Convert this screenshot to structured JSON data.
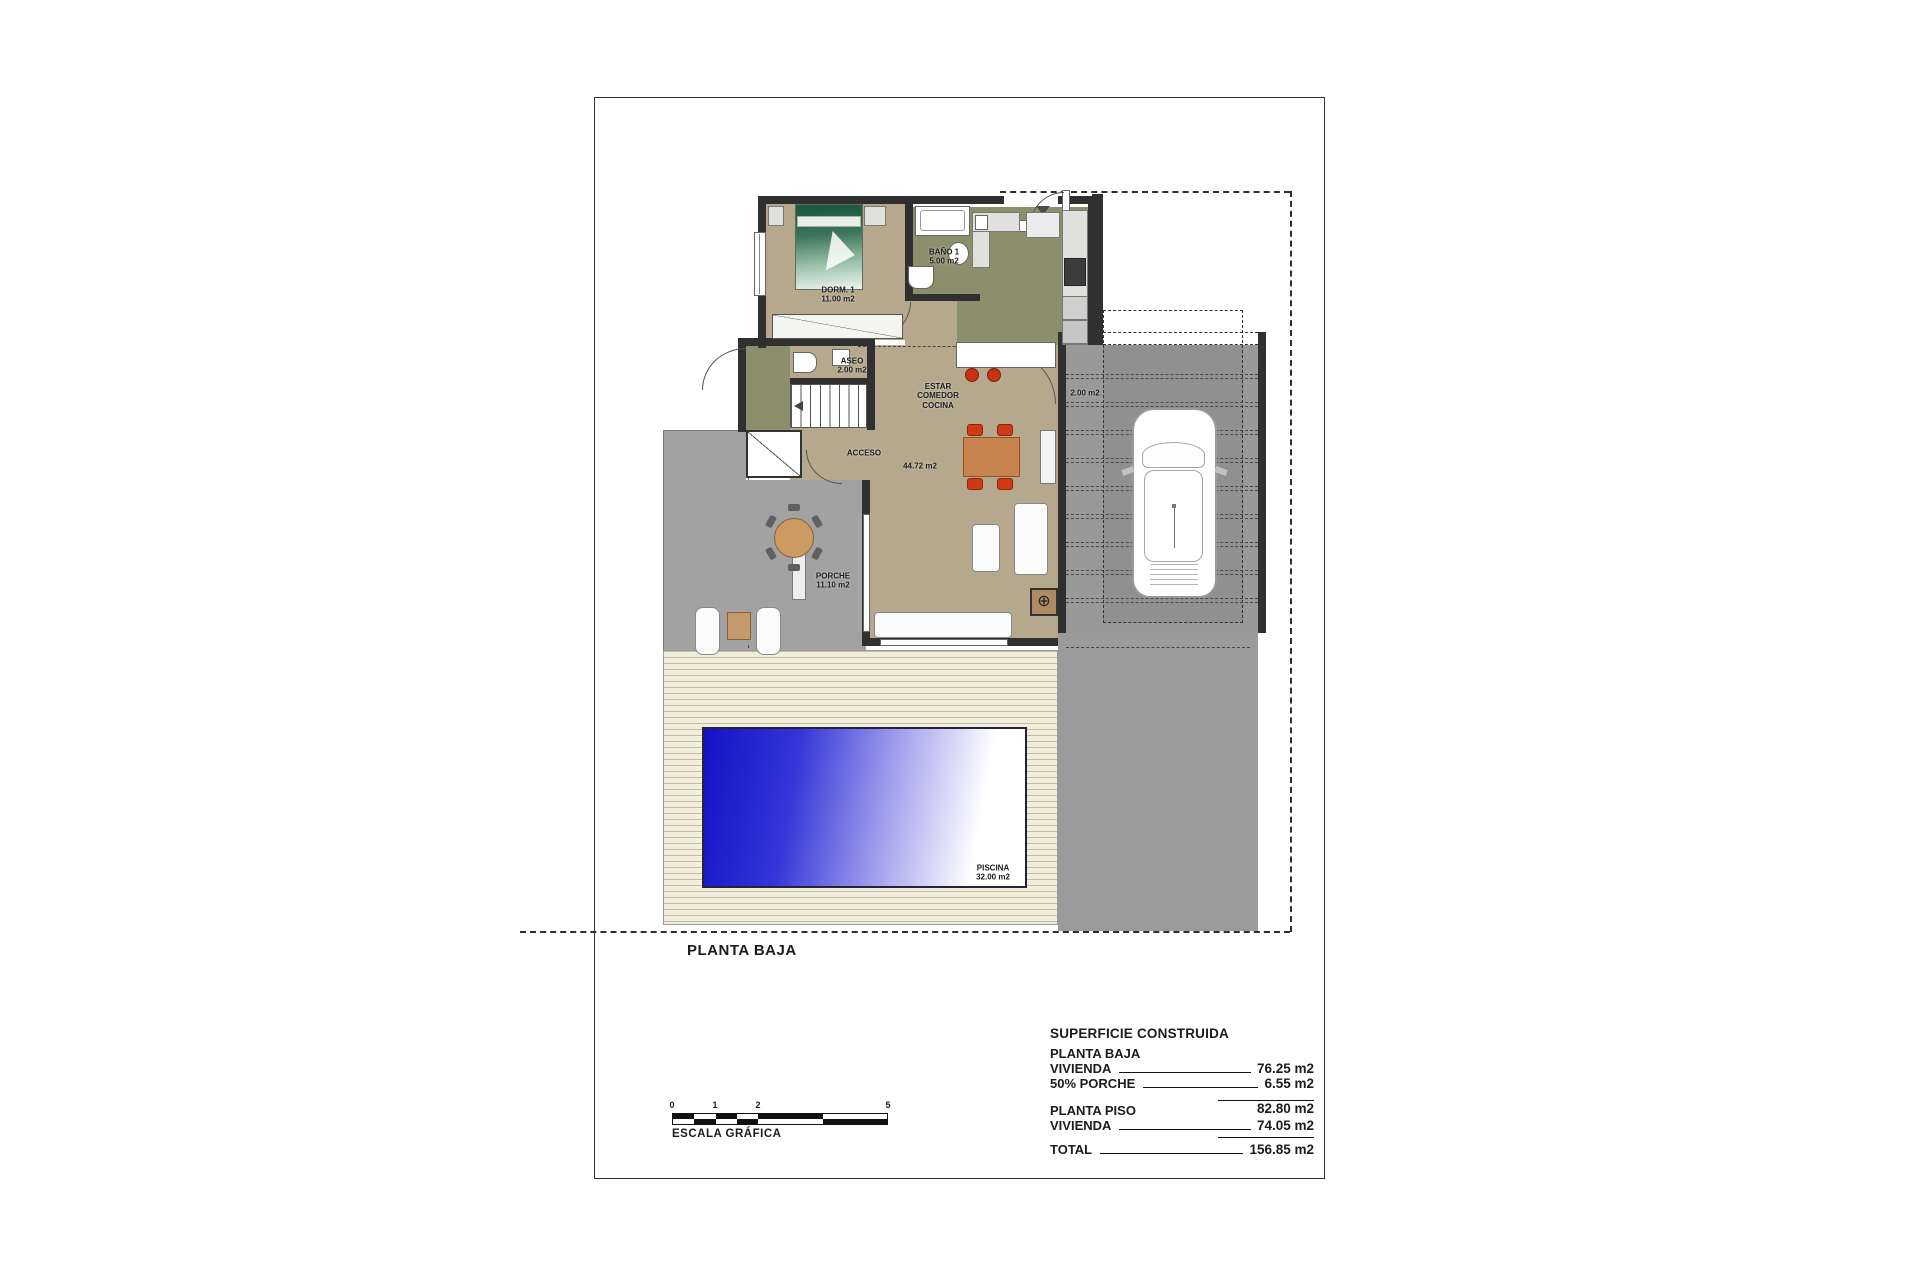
{
  "page": {
    "title": "PLANTA BAJA"
  },
  "rooms": {
    "dorm": {
      "name": "DORM. 1",
      "area": "11.00 m2"
    },
    "bano": {
      "name": "BAÑO 1",
      "area": "5.00 m2"
    },
    "aseo": {
      "name": "ASEO",
      "area": "2.00 m2"
    },
    "estar": {
      "line1": "ESTAR",
      "line2": "COMEDOR",
      "line3": "COCINA",
      "area": "44.72 m2"
    },
    "acceso": {
      "name": "ACCESO"
    },
    "porche": {
      "name": "PORCHE",
      "area": "11.10 m2"
    },
    "lateral": {
      "area": "2.00 m2"
    },
    "piscina": {
      "name": "PISCINA",
      "area": "32.00 m2"
    }
  },
  "scale": {
    "label": "ESCALA GRÁFICA",
    "ticks": [
      "0",
      "1",
      "2",
      "5"
    ]
  },
  "table": {
    "header": "SUPERFICIE CONSTRUIDA",
    "sections": [
      {
        "title": "PLANTA BAJA",
        "rows": [
          {
            "label": "VIVIENDA",
            "value": "76.25 m2"
          },
          {
            "label": "50% PORCHE",
            "value": "6.55 m2"
          }
        ],
        "subtotal": "82.80 m2"
      },
      {
        "title": "PLANTA PISO",
        "rows": [
          {
            "label": "VIVIENDA",
            "value": "74.05 m2"
          }
        ]
      }
    ],
    "total_label": "TOTAL",
    "total_value": "156.85 m2"
  },
  "colors": {
    "floor_tan": "#b5a88c",
    "floor_olive": "#8d8f6c",
    "terrace_gray": "#a2a2a2",
    "garage_gray": "#999999",
    "pool_blue": "#1414cd",
    "wall": "#303030"
  }
}
